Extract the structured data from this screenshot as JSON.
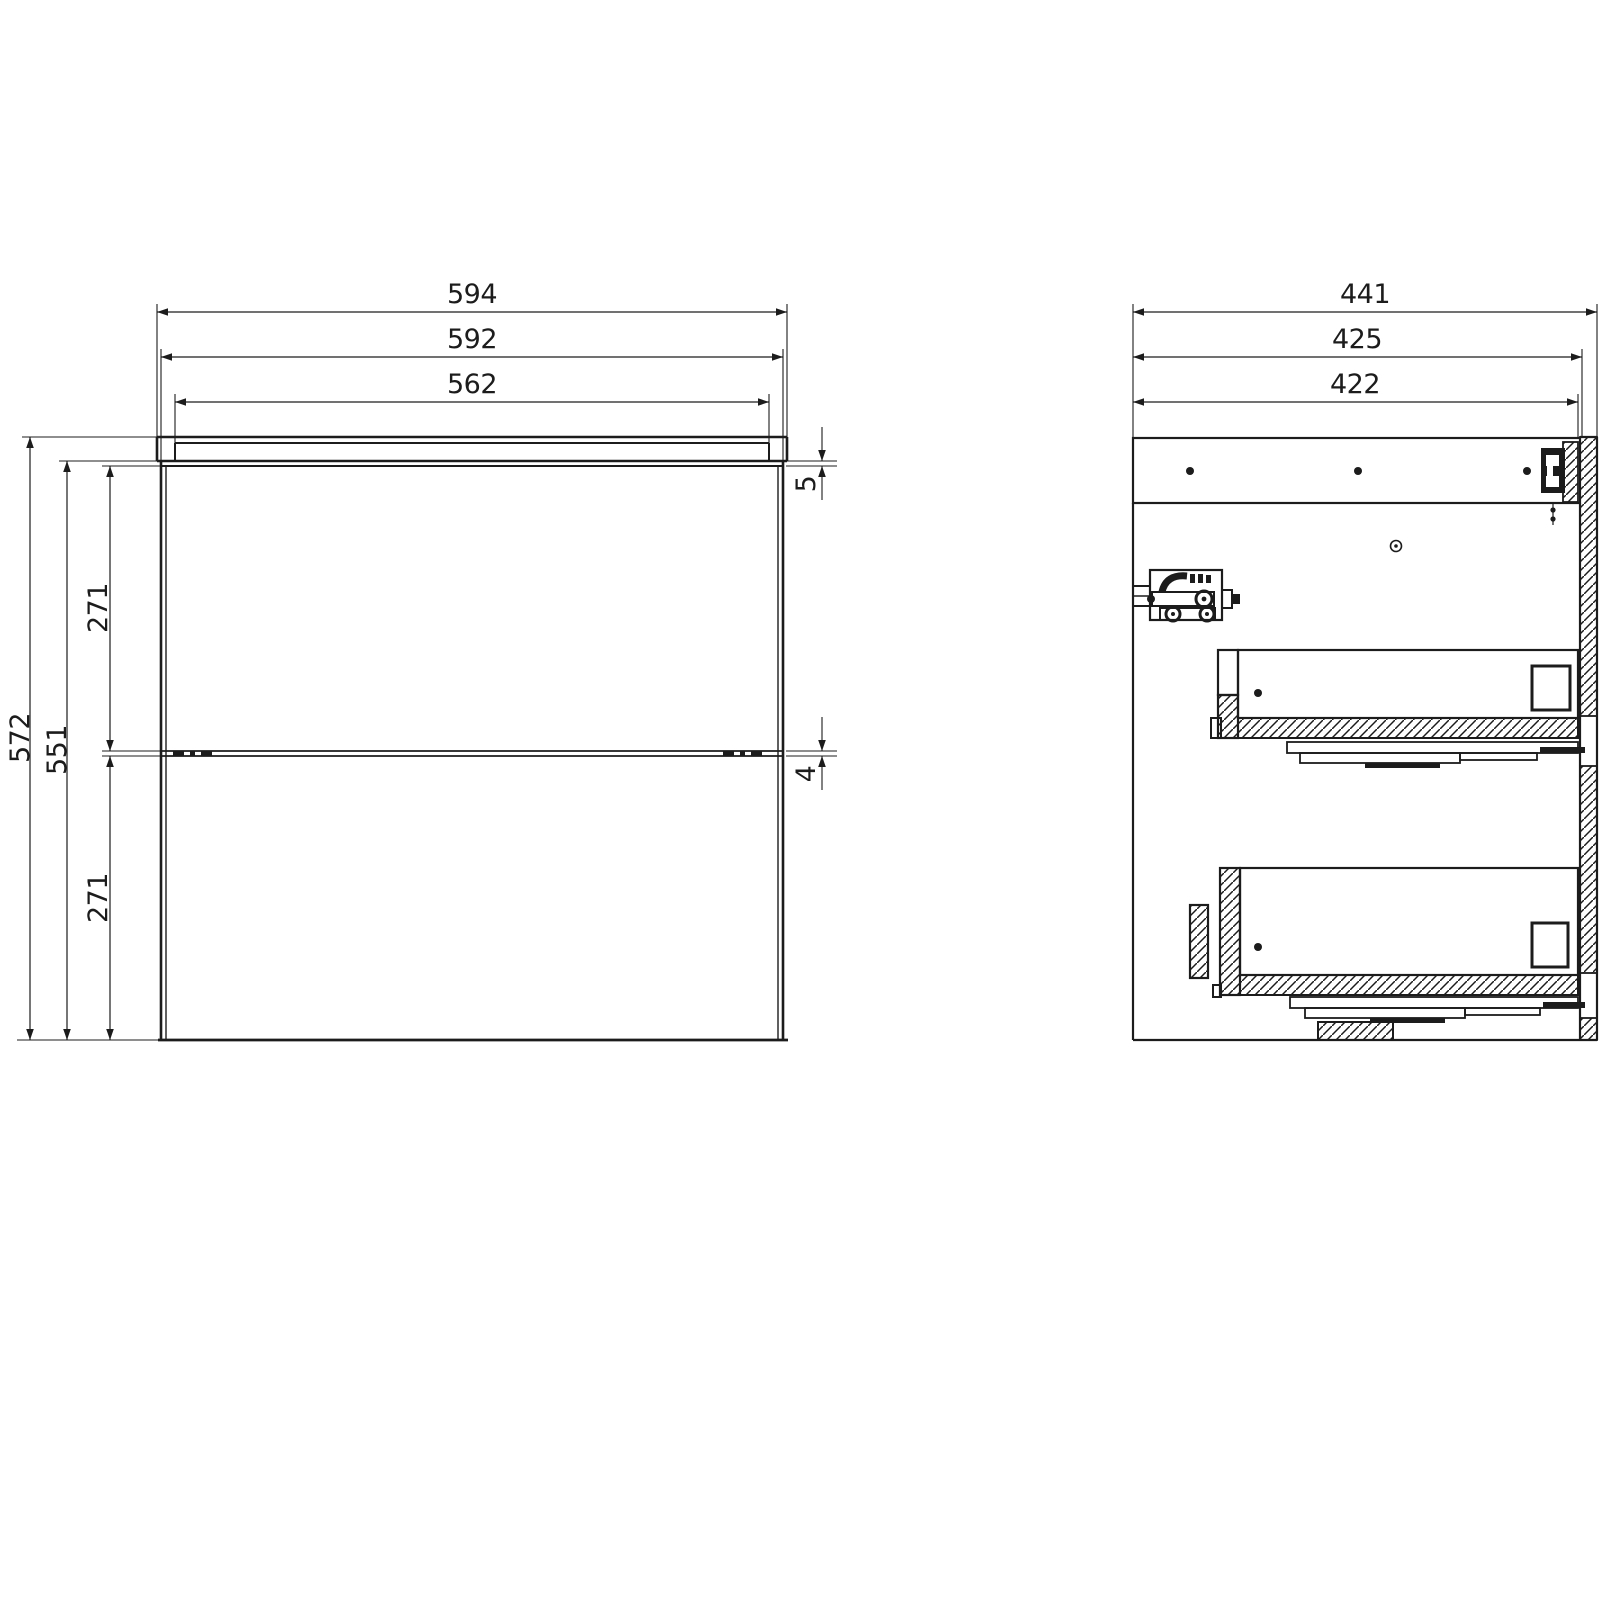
{
  "drawing": {
    "type": "technical-drawing",
    "subject": "two-drawer wall-hung cabinet, front view and side section view",
    "background": "#ffffff",
    "line_color": "#1c1c1c"
  },
  "dims": {
    "front_overall_width": "594",
    "front_carcass_width": "592",
    "front_drawer_width": "562",
    "front_overall_height": "572",
    "front_carcass_height": "551",
    "front_upper_drawer_height": "271",
    "front_lower_drawer_height": "271",
    "front_top_gap": "5",
    "front_drawer_gap": "4",
    "side_overall_depth": "441",
    "side_body_depth": "425",
    "side_carcass_depth": "422"
  }
}
